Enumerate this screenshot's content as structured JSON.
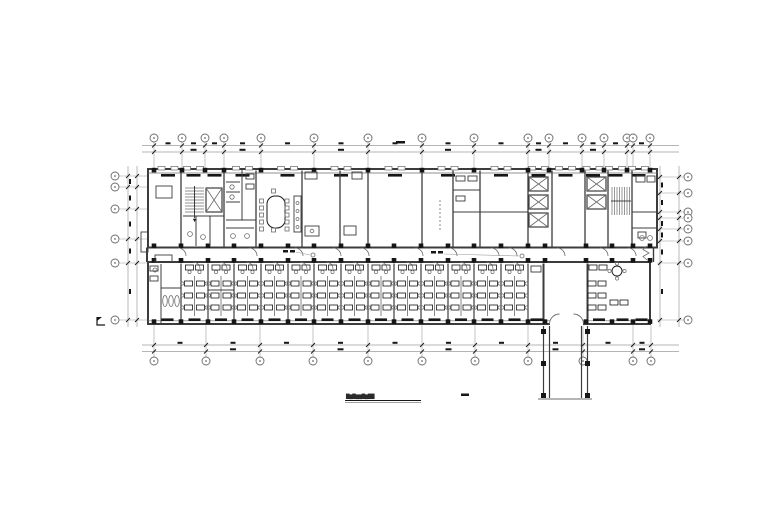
{
  "meta": {
    "kind": "architectural-floor-plan",
    "style": "cad-monochrome"
  },
  "palette": {
    "paper": "#ffffff",
    "ink": "#161616",
    "wall": "#3c3c3c",
    "mid": "#6b6b6b",
    "thin": "#9c9c9c"
  },
  "caption": {
    "text": "█▇█▇▇█▇██",
    "scale_mark": true
  },
  "grid": {
    "bubble_r": 4,
    "span_x": [
      148,
      657
    ],
    "span_y": [
      168,
      325
    ],
    "top": {
      "bubble_y": 138,
      "stem_y1": 142,
      "stem_y2": 168,
      "dim_y": [
        145.5,
        152
      ],
      "xs": [
        154,
        182,
        205,
        224,
        261,
        314,
        368,
        422,
        474,
        528,
        549,
        582,
        604,
        627,
        633,
        650
      ]
    },
    "bottom": {
      "bubble_y": 361,
      "stem_y1": 357,
      "stem_y2": 325,
      "dim_y": [
        345,
        351.5
      ],
      "xs": [
        154,
        206,
        260,
        313,
        368,
        422,
        475,
        528,
        583,
        633,
        651
      ]
    },
    "left": {
      "bubble_x": 115,
      "stem_x1": 119,
      "stem_x2": 148,
      "dim_x": [
        128,
        137
      ],
      "ys": [
        176,
        187,
        209,
        239,
        263,
        320
      ]
    },
    "right": {
      "bubble_x": 688,
      "stem_x1": 684,
      "stem_x2": 657,
      "dim_x": [
        660,
        679
      ],
      "ys": [
        177,
        193,
        212,
        218,
        229,
        241,
        263,
        320
      ]
    },
    "total_dim_smudge": [
      396,
      141,
      9,
      2.5
    ]
  },
  "building": {
    "upper_wing": [
      148,
      169,
      509,
      78.5
    ],
    "lower_wing": [
      148,
      262,
      502,
      62
    ],
    "top_inner_y": 173,
    "bottom_inner_y": 320.8,
    "upper_partitions": [
      181,
      224,
      256,
      302,
      340,
      368,
      422,
      453,
      480,
      528,
      552,
      585,
      608,
      632
    ],
    "lower_partitions": [
      181,
      208,
      234,
      261,
      288,
      314,
      341,
      368,
      394,
      421,
      448,
      474,
      501,
      528
    ],
    "lower_heavy_walls": [
      543.5,
      587.5
    ],
    "top_wall_cols": [
      154,
      182,
      205,
      224,
      261,
      314,
      368,
      422,
      474,
      528,
      549,
      582,
      604,
      627,
      650
    ],
    "column_xs": [
      154,
      181,
      208,
      234,
      261,
      288,
      314,
      341,
      368,
      394,
      421,
      448,
      474,
      501,
      528,
      545,
      586,
      612,
      633,
      650
    ],
    "column_rows_y": [
      245.8,
      260.3,
      321.6
    ],
    "entrance_gap": [
      550,
      583
    ],
    "corridor_door_xs": [
      178,
      249,
      295,
      333,
      361,
      415,
      449,
      491,
      509,
      557,
      600,
      628
    ]
  },
  "cores": {
    "elevator_shafts": [
      [
        529,
        177,
        19,
        14
      ],
      [
        529,
        195,
        19,
        14
      ],
      [
        529,
        213,
        19,
        14
      ],
      [
        587,
        177,
        19,
        14
      ],
      [
        587,
        195,
        19,
        14
      ],
      [
        206,
        188,
        16,
        24
      ]
    ],
    "stair_left": {
      "x1": 185,
      "x2": 204,
      "y1": 188,
      "y2": 214,
      "step": 3,
      "cx": 194.5
    },
    "stair_right": {
      "y1": 187,
      "y2": 215,
      "x1": 612,
      "x2": 630,
      "step": 2.5,
      "cy": 201
    }
  },
  "offices": {
    "desk_w": 8,
    "desk_h": 5,
    "chair_r": 1.6,
    "top_desk_y": 265,
    "row_ys": [
      281,
      293,
      305
    ],
    "spine_y": [
      276,
      316
    ],
    "big_office": {
      "table": [
        617,
        271,
        5
      ],
      "desks": [
        [
          589,
          265
        ],
        [
          599,
          265
        ],
        [
          588,
          281
        ],
        [
          598,
          281
        ],
        [
          588,
          293
        ],
        [
          598,
          293
        ],
        [
          588,
          305
        ],
        [
          598,
          305
        ],
        [
          610,
          300
        ],
        [
          620,
          300
        ]
      ],
      "table_chairs": [
        [
          617,
          263.5
        ],
        [
          609.5,
          271
        ],
        [
          624.5,
          271
        ],
        [
          617,
          278.5
        ]
      ]
    }
  },
  "meeting_room": {
    "table": [
      267,
      196,
      18,
      32
    ],
    "chair_ys": [
      199,
      206,
      213,
      220,
      227
    ],
    "left_x": 261.5,
    "right_x": 287,
    "chair_size": 4,
    "top_chair": [
      273.5,
      191
    ],
    "bottom_chair": [
      273.5,
      230
    ],
    "counter": [
      294,
      196,
      7,
      36
    ],
    "counter_dots_y": [
      203,
      211,
      219,
      227
    ]
  },
  "extension": {
    "wall_x": [
      543.5,
      549.5,
      581.5,
      587.5
    ],
    "y1": 326,
    "y2": 398,
    "col_ys": [
      329,
      361,
      393
    ],
    "end_line": [
      538,
      399,
      592,
      399
    ]
  },
  "details": {
    "lines": [
      [
        226,
        182,
        240,
        182
      ],
      [
        226,
        192,
        240,
        192
      ],
      [
        226,
        202,
        240,
        202
      ],
      [
        242,
        170,
        242,
        220
      ],
      [
        226,
        220,
        256,
        220
      ],
      [
        226,
        228,
        254,
        228
      ],
      [
        183,
        216,
        224,
        216
      ],
      [
        196,
        216,
        196,
        246
      ],
      [
        210,
        216,
        210,
        246
      ],
      [
        453,
        212,
        528,
        212
      ],
      [
        453,
        190,
        480,
        190
      ],
      [
        632,
        212,
        657,
        212
      ],
      [
        632,
        228,
        657,
        228
      ],
      [
        208,
        290,
        234,
        290
      ],
      [
        161,
        264,
        161,
        324
      ],
      [
        161,
        288,
        181,
        288
      ]
    ],
    "rects": [
      [
        156,
        186,
        16,
        12
      ],
      [
        305,
        172,
        12,
        7
      ],
      [
        305,
        226,
        14,
        10
      ],
      [
        344,
        226,
        12,
        9
      ],
      [
        352,
        172,
        10,
        7
      ],
      [
        456,
        176,
        9,
        5
      ],
      [
        468,
        176,
        9,
        5
      ],
      [
        456,
        196,
        9,
        5
      ],
      [
        636,
        176,
        9,
        6
      ],
      [
        647,
        176,
        8,
        6
      ],
      [
        150,
        266,
        8,
        5
      ],
      [
        150,
        276,
        8,
        5
      ],
      [
        531,
        266,
        10,
        6
      ],
      [
        638,
        232,
        8,
        6
      ],
      [
        155,
        255,
        17,
        7
      ],
      [
        141,
        232,
        7,
        20
      ],
      [
        246,
        174,
        8,
        5
      ],
      [
        246,
        184,
        8,
        5
      ]
    ],
    "circles": [
      [
        232,
        187,
        2.2
      ],
      [
        232,
        197,
        2.2
      ],
      [
        233,
        236,
        2.4
      ],
      [
        247,
        236,
        2.4
      ],
      [
        190,
        234,
        2.4
      ],
      [
        203,
        237,
        2.4
      ],
      [
        312,
        231,
        1.8
      ],
      [
        642,
        238,
        2.4
      ],
      [
        650,
        238,
        2.4
      ],
      [
        155,
        270,
        2
      ]
    ],
    "counter_dot_x": 297.5,
    "ellipses": [
      [
        165,
        301,
        2.3,
        5.5
      ],
      [
        171,
        301,
        2.3,
        5.5
      ],
      [
        177,
        301,
        2.3,
        5.5
      ]
    ],
    "dashed_lines": [
      [
        440,
        200,
        440,
        232
      ]
    ],
    "break_path": "M647,246 l-4,3.5 l6,3.5 l-6,3.5 l4,3.5",
    "vestibule_doors": [
      "M549.5,324 A10 10 0 0 1 559.5,314",
      "M583.5,324 A10 10 0 0 0 573.5,314"
    ],
    "leader_lines": [
      [
        296,
        252,
        310,
        255
      ],
      [
        444,
        254,
        519,
        256
      ]
    ],
    "leader_smudges": [
      [
        283,
        250,
        5,
        2.5
      ],
      [
        290,
        250,
        5,
        2.5
      ],
      [
        431,
        251,
        5,
        2.5
      ],
      [
        438,
        251,
        5,
        2.5
      ]
    ],
    "leader_circles": [
      [
        313,
        255,
        2
      ],
      [
        522,
        256,
        2
      ]
    ],
    "section_mark": {
      "path": "M97,317 v8 h8",
      "flag": "M97,317 h5 l-5,4 z"
    },
    "caption_underline": [
      [
        345,
        400.5,
        421,
        400.5
      ],
      [
        345,
        402.3,
        421,
        402.3
      ]
    ],
    "scale_smudge": [
      461,
      393.5,
      8,
      2.5
    ]
  }
}
